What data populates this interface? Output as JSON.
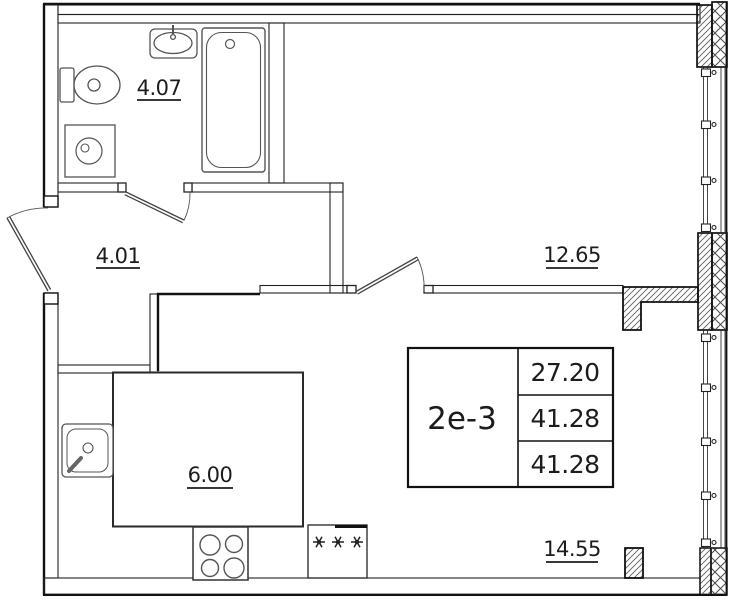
{
  "plan": {
    "unit_type": "2е-3",
    "info_table": {
      "type_label": "2е-3",
      "rows": [
        "27.20",
        "41.28",
        "41.28"
      ]
    },
    "rooms": [
      {
        "name": "bathroom",
        "area": "4.07"
      },
      {
        "name": "hallway",
        "area": "4.01"
      },
      {
        "name": "bedroom",
        "area": "12.65"
      },
      {
        "name": "kitchen-niche",
        "area": "6.00"
      },
      {
        "name": "living-room",
        "area": "14.55"
      }
    ],
    "fixtures": [
      "toilet",
      "bathroom-sink",
      "bathtub",
      "washing-machine",
      "kitchen-sink",
      "stove-4-burner",
      "refrigerator"
    ],
    "colors": {
      "line": "#1c1c1c",
      "hatch": "#555555",
      "background": "#ffffff"
    }
  }
}
